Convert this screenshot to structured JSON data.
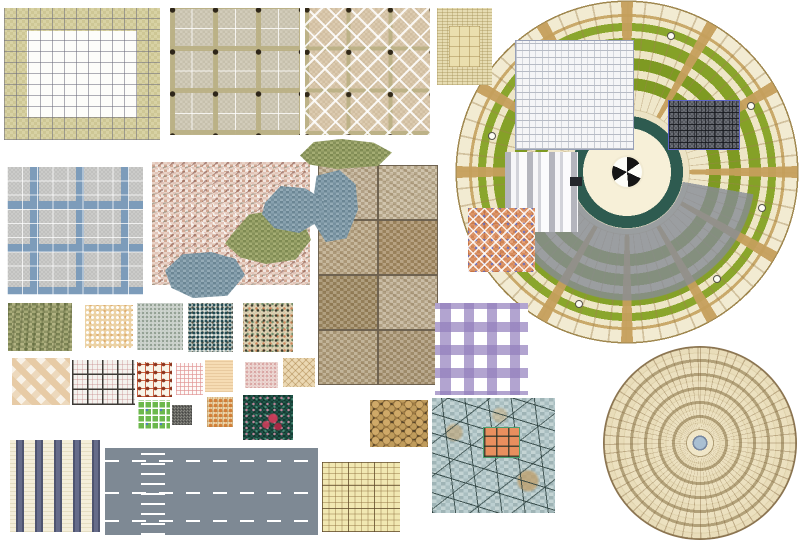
{
  "page": {
    "background": "#ffffff",
    "sheet_label": "Paving and tile texture swatch sheet (landscape material library)"
  },
  "plaza": {
    "label": "Circular plaza paving plan with grass ring wedges and central fan motif",
    "colors": {
      "paving": "#f2ebd2",
      "grass": "#7f9c1f",
      "spoke_band": "#c9a96a",
      "inner_ring": "#2e5b50",
      "gray_band": "#868c96",
      "edge": "#a08850"
    },
    "center_icon": "fan-icon",
    "marker_icon": "light-marker"
  },
  "concentric": {
    "label": "Concentric ring paver circle with blue center drain",
    "colors": {
      "paver": "#ece1c0",
      "ring_band": "#b2a179",
      "joint": "#8a7350",
      "center": "#a9bfd2"
    }
  },
  "swatches": {
    "border_grid": {
      "label": "White mosaic tile field with khaki double border band",
      "colors": [
        "#ffffff",
        "#d5cf9e",
        "#6c6c7c"
      ]
    },
    "granite_dots": {
      "label": "Beige granite paving with olive bands and dark square insets",
      "colors": [
        "#cfc9b6",
        "#bab084",
        "#2e2619"
      ]
    },
    "diag_cross": {
      "label": "Tan paving with white diagonal cross pattern and dark insets",
      "colors": [
        "#d7c6ab",
        "#ffffff",
        "#312817"
      ]
    },
    "parquet": {
      "label": "Woven parquet border swatch with plain center panel",
      "colors": [
        "#e6dcb2",
        "#cbbd8c",
        "#eadfae"
      ]
    },
    "brick": {
      "label": "White brick running bond swatch",
      "colors": [
        "#f5f5f7",
        "#b7bbc5"
      ]
    },
    "awning": {
      "label": "Gray and white vertical stripe swatch",
      "colors": [
        "#b4b5bd",
        "#f6f6f8"
      ]
    },
    "dark_chip": {
      "label": "Small dark tile chip",
      "colors": [
        "#23262b"
      ]
    },
    "dark_stone": {
      "label": "Dark gray random ashlar stone with blue border",
      "colors": [
        "#5f626a",
        "#16181d",
        "#5a62c8"
      ]
    },
    "orange_mosaic": {
      "label": "Terracotta mosaic with white diamond lattice and blue dots",
      "colors": [
        "#d88c5e",
        "#ffffff",
        "#5a6ed2"
      ]
    },
    "blue_grout": {
      "label": "Gray granite paving with steel-blue grout bands",
      "colors": [
        "#c6c6c4",
        "#7d9cba",
        "#ffffff"
      ]
    },
    "pink_granite": {
      "label": "Pink granite terrazzo slab",
      "colors": [
        "#e2c4b8",
        "#d2a894",
        "#f1e7e0"
      ]
    },
    "flagstones": {
      "label": "Irregular flagstone pieces, olive green and blue gray",
      "colors": [
        "#8f985e",
        "#7d96a4"
      ]
    },
    "slate_grid": {
      "label": "Mottled sandstone tile grid, two by four",
      "colors": [
        "#c2b297",
        "#a78e66",
        "#6e6250"
      ]
    },
    "stone_olive": {
      "label": "Rough olive stone texture",
      "colors": [
        "#9aa06e",
        "#7c8455"
      ]
    },
    "terrazzo_peach": {
      "label": "Peach terrazzo with white speckles",
      "colors": [
        "#ecd2a4",
        "#ffffff"
      ]
    },
    "terrazzo_gray": {
      "label": "Light gray-green terrazzo speckle",
      "colors": [
        "#cdd3cd"
      ]
    },
    "terrazzo_dark": {
      "label": "Terrazzo with dense dark teal speckles",
      "colors": [
        "#ccd2c8",
        "#123e48"
      ]
    },
    "terrazzo_tan": {
      "label": "Tan terrazzo with multicolor chips",
      "colors": [
        "#d8ccae",
        "#282820",
        "#c85a28",
        "#326946"
      ]
    },
    "plaid_purple": {
      "label": "Lavender plaid band tile",
      "colors": [
        "#ffffff",
        "#927ebc"
      ]
    },
    "diamond_pink": {
      "label": "Pink diamond checker tile",
      "colors": [
        "#e7cba6",
        "#f8f2e8"
      ]
    },
    "dark_grid": {
      "label": "White tile with dark grid joints and fine pink lines",
      "colors": [
        "#f4f2ee",
        "#3e3a36",
        "#c88c8c"
      ]
    },
    "red_grid": {
      "label": "Cream tile with red-orange grid and corner dots",
      "colors": [
        "#f8f4e8",
        "#c24a28",
        "#8a3018"
      ]
    },
    "fine_pink_grid": {
      "label": "Fine pink grid tile",
      "colors": [
        "#fdf9f8",
        "#e19696"
      ]
    },
    "peach_plain": {
      "label": "Plain peach weave swatch",
      "colors": [
        "#f6dcb4"
      ]
    },
    "pink_speckle": {
      "label": "Pale pink speckle swatch",
      "colors": [
        "#ecd4d0"
      ]
    },
    "weave_diag": {
      "label": "Beige diagonal basket weave",
      "colors": [
        "#ecd9b4",
        "#a0783c"
      ]
    },
    "green_grid": {
      "label": "Green mosaic grid with blue dots",
      "colors": [
        "#6cb84c",
        "#ffffff",
        "#4670dc"
      ]
    },
    "gray_chip": {
      "label": "Small gray speckle chip",
      "colors": [
        "#84847e"
      ]
    },
    "orange_weave": {
      "label": "Beige basket weave with orange dots",
      "colors": [
        "#ecd6ac",
        "#d0762c"
      ]
    },
    "green_floral": {
      "label": "Dark green floral carpet with red flower",
      "colors": [
        "#1a4a40",
        "#cd3c5a",
        "#e696b4"
      ]
    },
    "pebbles": {
      "label": "Brown pebble paving",
      "colors": [
        "#473a26",
        "#cfa968",
        "#8a6a38"
      ]
    },
    "crazy_paving": {
      "label": "Blue-gray crazy paving with terracotta tile inset",
      "colors": [
        "#b2c6c8",
        "#28423c",
        "#e98f5e"
      ]
    },
    "stripes": {
      "label": "Cream and navy vertical stripe paving",
      "colors": [
        "#f4eeda",
        "#4e5470"
      ]
    },
    "road": {
      "label": "Asphalt road with white lane markings and crossing dashes",
      "colors": [
        "#7e8994",
        "#ffffff"
      ]
    },
    "yellow_grid": {
      "label": "Pale yellow graph-grid tile",
      "colors": [
        "#f1e8b2",
        "#5a4628"
      ]
    }
  }
}
